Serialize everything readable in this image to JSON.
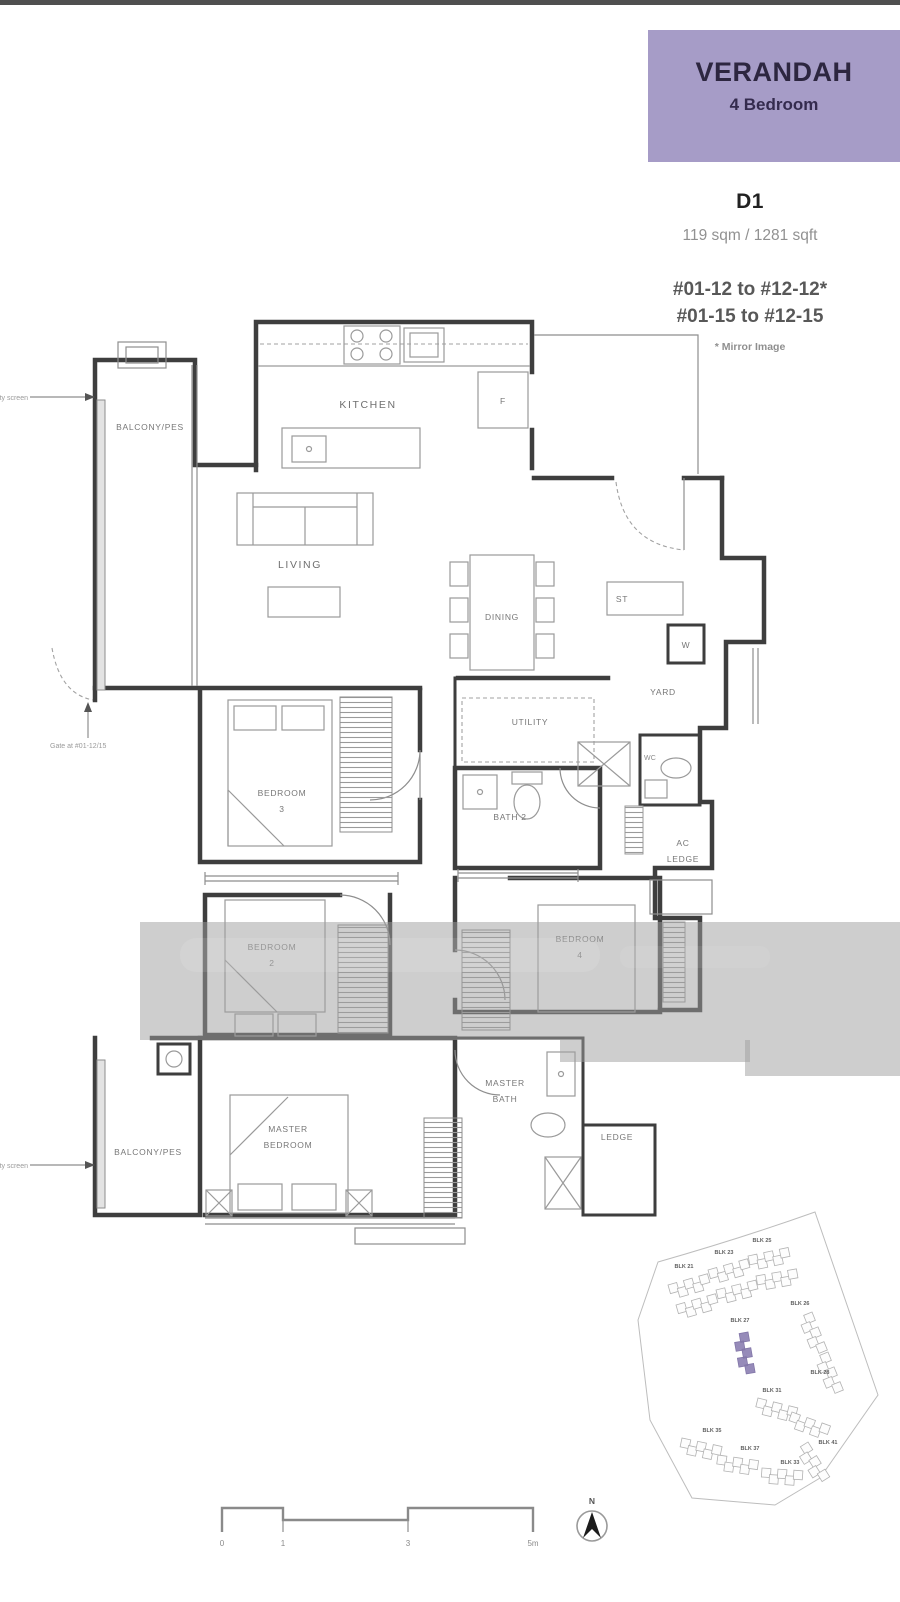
{
  "header": {
    "project_name": "VERANDAH",
    "unit_type": "4 Bedroom",
    "accent_color": "#a69cc7"
  },
  "unit_info": {
    "code": "D1",
    "area": "119 sqm / 1281 sqft",
    "stack_line1": "#01-12 to #12-12*",
    "stack_line2": "#01-15 to #12-15",
    "mirror_note": "* Mirror Image"
  },
  "floorplan": {
    "rooms": {
      "balcony_top": "BALCONY/PES",
      "kitchen": "KITCHEN",
      "fridge": "F",
      "living": "LIVING",
      "dining": "DINING",
      "store": "ST",
      "washer": "W",
      "yard": "YARD",
      "utility": "UTILITY",
      "wc": "WC",
      "bath2": "BATH 2",
      "ac_ledge_l1": "AC",
      "ac_ledge_l2": "LEDGE",
      "bedroom3_l1": "BEDROOM",
      "bedroom3_l2": "3",
      "bedroom2_l1": "BEDROOM",
      "bedroom2_l2": "2",
      "bedroom4_l1": "BEDROOM",
      "bedroom4_l2": "4",
      "master_bath_l1": "MASTER",
      "master_bath_l2": "BATH",
      "master_bedroom_l1": "MASTER",
      "master_bedroom_l2": "BEDROOM",
      "ledge": "LEDGE",
      "balcony_bottom": "BALCONY/PES"
    },
    "annotations": {
      "safety_screen_top": "Safety screen",
      "safety_screen_bottom": "Safety screen",
      "gate": "Gate at #01-12/15"
    }
  },
  "scale_bar": {
    "ticks": [
      "0",
      "1",
      "3",
      "5m"
    ]
  },
  "north_indicator": {
    "label": "N"
  },
  "site_plan": {
    "highlight_color": "#8b7fb2",
    "blocks": [
      {
        "label": "BLK 21"
      },
      {
        "label": "BLK 23"
      },
      {
        "label": "BLK 25"
      },
      {
        "label": "BLK 26"
      },
      {
        "label": "BLK 27",
        "highlighted": true
      },
      {
        "label": "BLK 28"
      },
      {
        "label": "BLK 31"
      },
      {
        "label": "BLK 33"
      },
      {
        "label": "BLK 35"
      },
      {
        "label": "BLK 37"
      },
      {
        "label": "BLK 41"
      }
    ]
  }
}
